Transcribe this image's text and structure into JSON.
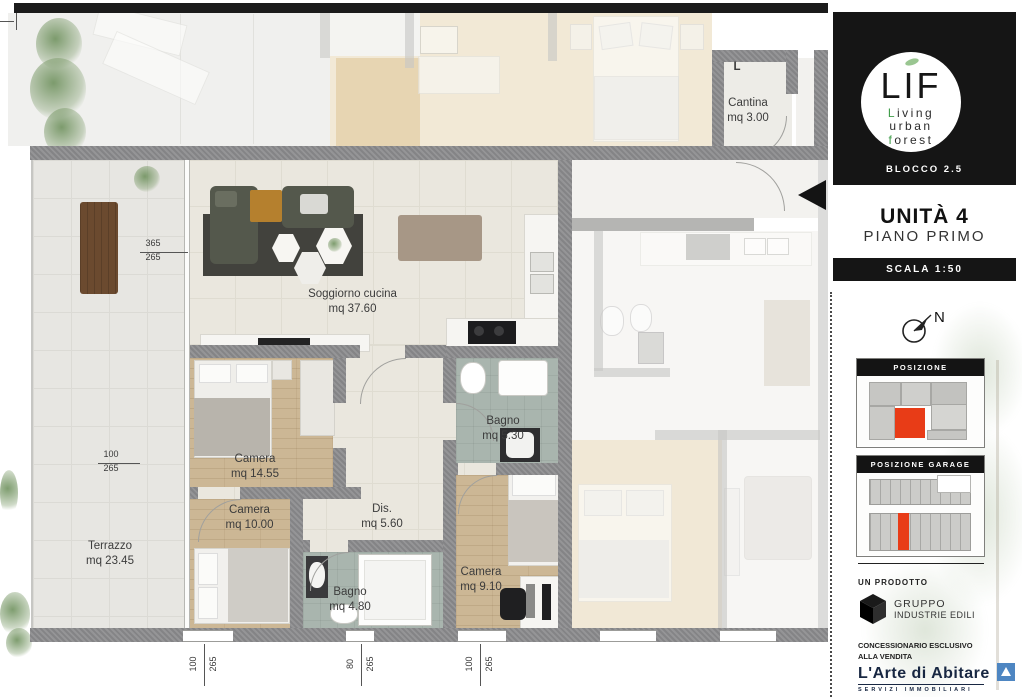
{
  "plan": {
    "cantina_letter": "L",
    "rooms": [
      {
        "name": "Cantina",
        "area": "mq 3.00"
      },
      {
        "name": "Soggiorno cucina",
        "area": "mq 37.60"
      },
      {
        "name": "Camera",
        "area": "mq 14.55"
      },
      {
        "name": "Bagno",
        "area": "mq 5.30"
      },
      {
        "name": "Camera",
        "area": "mq 10.00"
      },
      {
        "name": "Dis.",
        "area": "mq 5.60"
      },
      {
        "name": "Bagno",
        "area": "mq 4.80"
      },
      {
        "name": "Camera",
        "area": "mq 9.10"
      },
      {
        "name": "Terrazzo",
        "area": "mq 23.45"
      }
    ],
    "dims": {
      "left_upper": {
        "top": "365",
        "bottom": "265"
      },
      "left_lower": {
        "top": "100",
        "bottom": "265"
      },
      "bottom": [
        {
          "top": "100",
          "bottom": "265"
        },
        {
          "top": "80",
          "bottom": "265"
        },
        {
          "top": "100",
          "bottom": "265"
        }
      ]
    }
  },
  "sidebar": {
    "logo": {
      "acronym": "LIF",
      "word1": "Living",
      "word2": "urban",
      "word3": "forest",
      "block": "BLOCCO 2.5"
    },
    "unit": {
      "title": "UNITÀ 4",
      "floor": "PIANO PRIMO"
    },
    "scale_label": "SCALA 1:50",
    "compass_label": "N",
    "position_title": "POSIZIONE",
    "garage_title": "POSIZIONE GARAGE",
    "producer": {
      "label": "UN PRODOTTO",
      "name_line1": "GRUPPO",
      "name_line2": "INDUSTRIE EDILI"
    },
    "dealer": {
      "line1": "CONCESSIONARIO ESCLUSIVO",
      "line2": "ALLA VENDITA",
      "brand": "L'Arte di Abitare",
      "sub": "SERVIZI IMMOBILIARI"
    }
  },
  "colors": {
    "accent_red": "#e83c17",
    "panel_black": "#151515",
    "logo_green": "#3f9d49",
    "dealer_blue": "#4e86c2",
    "wall_gray": "#8f8f91"
  }
}
